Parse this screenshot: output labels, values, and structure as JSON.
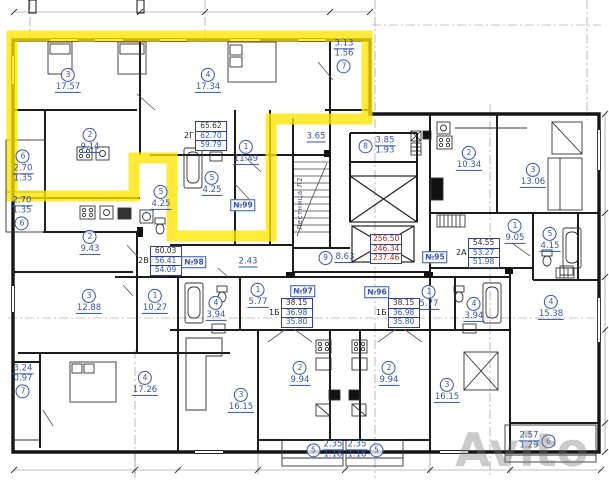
{
  "watermark": "Avito",
  "stair_label": "Лестница Л2",
  "highlight_color": "#ffe400",
  "label_color": "#3656ad",
  "totals": {
    "rows": [
      "256.50",
      "246.34",
      "237.46"
    ]
  },
  "apartments": [
    {
      "id": "2Г",
      "rows": [
        "65.62",
        "62.70",
        "59.79"
      ],
      "tag": "№99"
    },
    {
      "id": "2В",
      "rows": [
        "60.03",
        "56.41",
        "54.09"
      ],
      "tag": "№98"
    },
    {
      "id": "1Б",
      "rows": [
        "38.15",
        "36.98",
        "35.80"
      ],
      "tag": "№97"
    },
    {
      "id": "1Б",
      "rows": [
        "38.15",
        "36.98",
        "35.80"
      ],
      "tag": "№96"
    },
    {
      "id": "2А",
      "rows": [
        "54.55",
        "53.27",
        "51.98"
      ],
      "tag": "№95"
    }
  ],
  "rooms": [
    {
      "num": "3",
      "area": "17.57",
      "x": 68,
      "y": 80,
      "lay": "v"
    },
    {
      "num": "4",
      "area": "17.34",
      "x": 208,
      "y": 80,
      "lay": "v"
    },
    {
      "num": "7",
      "area": "3.13",
      "area2": "1.56",
      "x": 344,
      "y": 57,
      "lay": "va"
    },
    {
      "num": "2",
      "area": "9.14",
      "x": 90,
      "y": 140,
      "lay": "v"
    },
    {
      "num": "1",
      "area": "11.49",
      "x": 246,
      "y": 152,
      "lay": "v"
    },
    {
      "num": "5",
      "area": "4.25",
      "x": 212,
      "y": 183,
      "lay": "v"
    },
    {
      "num": "5",
      "area": "4.25",
      "x": 161,
      "y": 197,
      "lay": "v"
    },
    {
      "num": "6",
      "area": "2.70",
      "area2": "1.35",
      "x": 23,
      "y": 166,
      "lay": "v2"
    },
    {
      "num": "6",
      "area": "2.70",
      "area2": "1.35",
      "x": 22,
      "y": 214,
      "lay": "va"
    },
    {
      "num": "2",
      "area": "9.43",
      "x": 90,
      "y": 242,
      "lay": "v"
    },
    {
      "num": "3",
      "area": "12.88",
      "x": 89,
      "y": 301,
      "lay": "v"
    },
    {
      "num": "1",
      "area": "10.27",
      "x": 155,
      "y": 301,
      "lay": "v"
    },
    {
      "num": "4",
      "area": "17.26",
      "x": 145,
      "y": 383,
      "lay": "v"
    },
    {
      "num": "7",
      "area": "3.24",
      "area2": "0.97",
      "x": 23,
      "y": 382,
      "lay": "va"
    },
    {
      "num": "8",
      "area": "3.85",
      "area2": "1.93",
      "x": 377,
      "y": 146,
      "lay": "h"
    },
    {
      "num": "9",
      "area": "8.63",
      "x": 337,
      "y": 258,
      "lay": "h"
    },
    {
      "num": "1",
      "area": "5.77",
      "x": 258,
      "y": 295,
      "lay": "v"
    },
    {
      "num": "4",
      "area": "3.94",
      "x": 216,
      "y": 308,
      "lay": "v"
    },
    {
      "num": "2",
      "area": "9.94",
      "x": 300,
      "y": 373,
      "lay": "v"
    },
    {
      "num": "3",
      "area": "16.15",
      "x": 241,
      "y": 400,
      "lay": "v"
    },
    {
      "num": "1",
      "area": "5.77",
      "x": 429,
      "y": 297,
      "lay": "v"
    },
    {
      "num": "4",
      "area": "3.94",
      "x": 474,
      "y": 309,
      "lay": "v"
    },
    {
      "num": "2",
      "area": "9.94",
      "x": 389,
      "y": 373,
      "lay": "v"
    },
    {
      "num": "3",
      "area": "16.15",
      "x": 447,
      "y": 390,
      "lay": "v"
    },
    {
      "num": "2",
      "area": "10.34",
      "x": 469,
      "y": 158,
      "lay": "v"
    },
    {
      "num": "3",
      "area": "13.06",
      "x": 533,
      "y": 175,
      "lay": "v"
    },
    {
      "num": "1",
      "area": "9.05",
      "x": 515,
      "y": 231,
      "lay": "v"
    },
    {
      "num": "5",
      "area": "4.15",
      "x": 550,
      "y": 239,
      "lay": "v"
    },
    {
      "num": "4",
      "area": "15.38",
      "x": 551,
      "y": 307,
      "lay": "v"
    },
    {
      "num": "5",
      "area": "2.35",
      "area2": "1.18",
      "x": 325,
      "y": 450,
      "lay": "h"
    },
    {
      "num": "5",
      "area": "2.35",
      "area2": "1.18",
      "x": 365,
      "y": 450,
      "lay": "hr"
    },
    {
      "num": "6",
      "area": "2.57",
      "area2": "1.29",
      "x": 537,
      "y": 441,
      "lay": "hr"
    }
  ],
  "dims": [
    {
      "text": "3.65",
      "x": 316,
      "y": 137
    },
    {
      "text": "2.43",
      "x": 248,
      "y": 262
    }
  ]
}
